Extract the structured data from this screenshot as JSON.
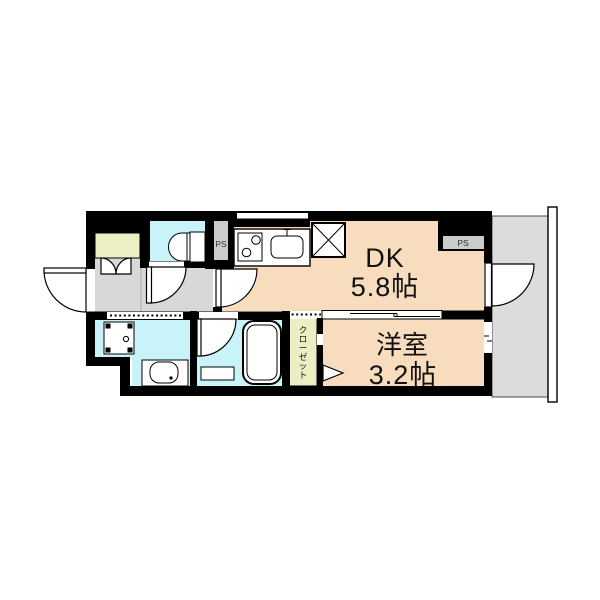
{
  "plan_type": "apartment-floor-plan",
  "rooms": {
    "dk": {
      "label": "DK",
      "area": "5.8帖"
    },
    "western_room": {
      "label": "洋室",
      "area": "3.2帖"
    },
    "closet": {
      "label": "クローゼット"
    },
    "pipe_space_top": {
      "label": "PS"
    },
    "pipe_space_right": {
      "label": "PS"
    }
  },
  "colors": {
    "wall": "#000000",
    "room_floor": "#f8dcbe",
    "wet_area_floor": "#c8f3f8",
    "storage_floor": "#edeec3",
    "hall_floor": "#d8d8d8",
    "balcony_floor": "#dcdcdc",
    "ps_niche": "#cbcbcb",
    "text": "#111111"
  }
}
